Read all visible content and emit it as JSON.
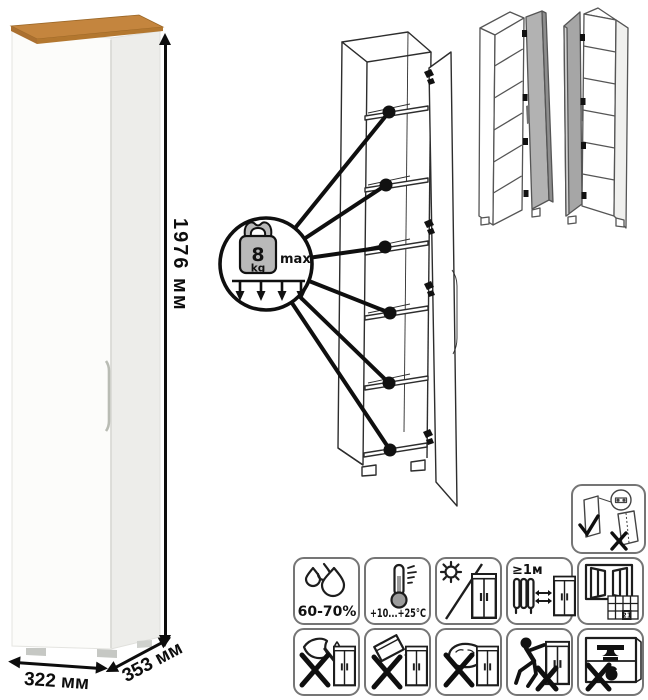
{
  "dimensions": {
    "height": "1976 мм",
    "width": "322 мм",
    "depth": "353 мм"
  },
  "load_callout": {
    "value": "8",
    "unit": "kg",
    "qualifier": "max"
  },
  "care": {
    "humidity_label": "60-70%",
    "temperature_label": "+10...+25°C",
    "min_distance_label": "≥1м",
    "calendar_day": "21"
  },
  "colors": {
    "wood_top": "#c4853e",
    "cabinet_white": "#fbfbfa",
    "side_shade": "#ededea",
    "line_art": "#2d2d2d",
    "door_gray": "#b2b2b2"
  }
}
